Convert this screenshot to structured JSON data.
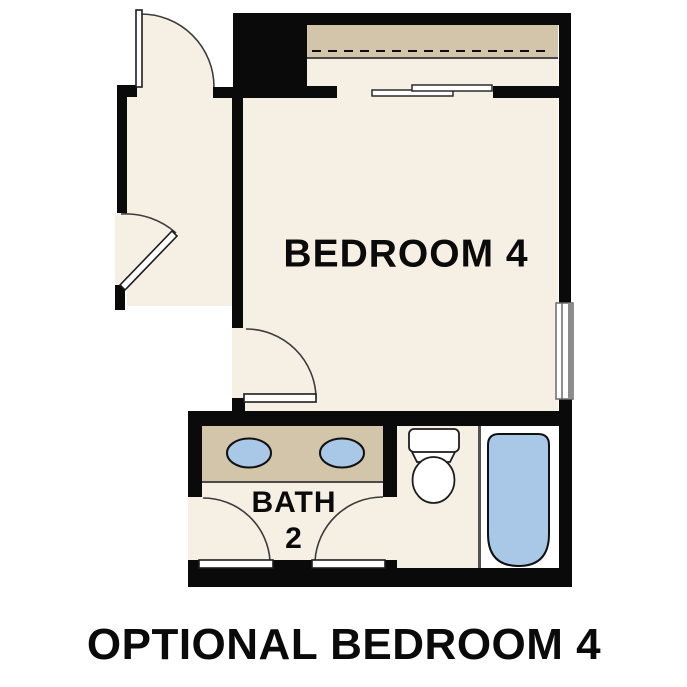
{
  "plan": {
    "caption": "OPTIONAL BEDROOM 4",
    "rooms": {
      "bedroom": {
        "label": "BEDROOM 4"
      },
      "bath": {
        "label_line1": "BATH",
        "label_line2": "2"
      }
    },
    "fixtures": [
      "double-sink-vanity",
      "sink-basin-left",
      "sink-basin-right",
      "toilet",
      "bathtub",
      "closet-shelf-with-rod",
      "bypass-sliding-closet-doors",
      "window",
      "swing-door-top-entry",
      "swing-door-left-entry",
      "swing-door-bedroom",
      "swing-door-bath-left",
      "swing-door-bath-right"
    ]
  },
  "colors": {
    "floor": "#f6efe4",
    "counter": "#d2c5a9",
    "fixture": "#a9c8e8",
    "wall": "#0a0a0a",
    "tubroom": "#ffffff",
    "ink": "#0a0a0a",
    "line": "#3c3c3c"
  }
}
